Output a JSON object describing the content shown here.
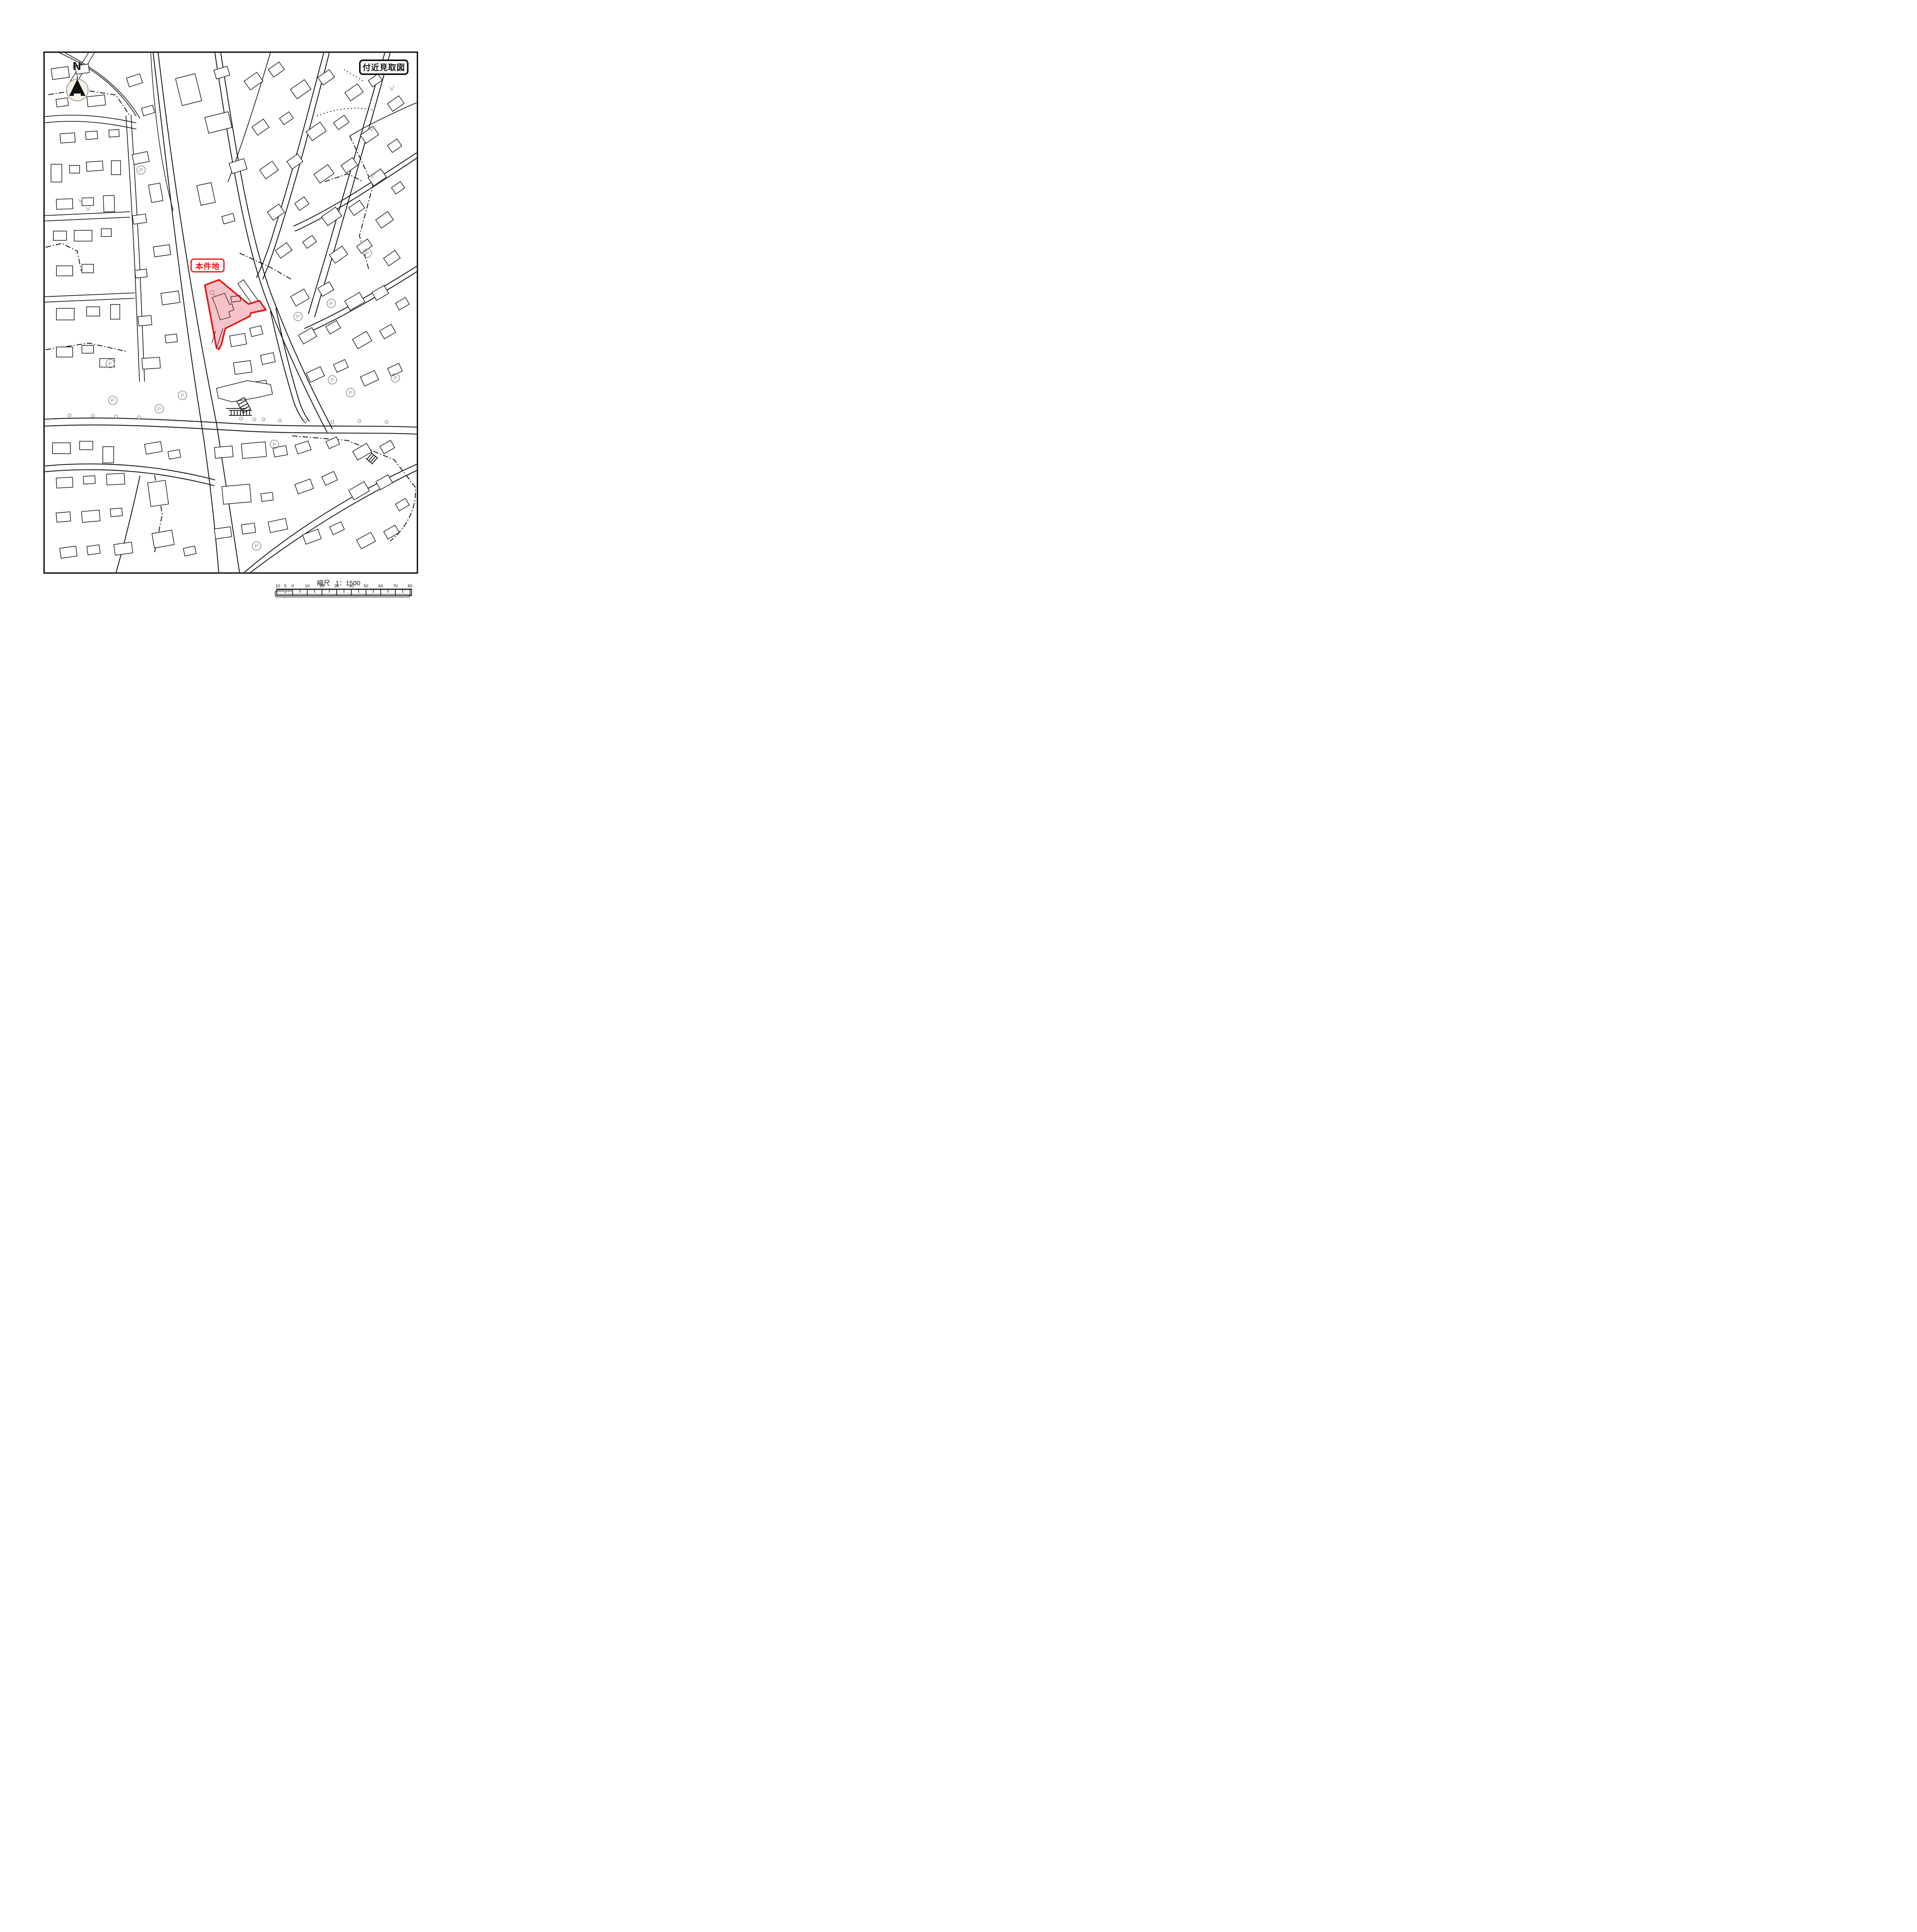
{
  "title_box": {
    "label": "付近見取図"
  },
  "north_indicator": {
    "label": "N"
  },
  "subject_site": {
    "label": "本件地",
    "outline_color": "#e8100c",
    "fill_color": "#f7c3c8"
  },
  "scale": {
    "label": "縮尺",
    "ratio": "1：1500"
  },
  "scale_bar": {
    "left_labels": [
      "10",
      "5",
      "0"
    ],
    "main_labels": [
      "10",
      "20",
      "30",
      "40",
      "50",
      "60",
      "70",
      "80"
    ]
  },
  "map_symbols": {
    "parking": "P"
  },
  "colors": {
    "line": "#151515",
    "highlight_stroke": "#e8100c",
    "highlight_fill": "#f7c3c8",
    "symbol_gray": "#8f8f8f",
    "compass_fill": "#f6f2e6"
  }
}
